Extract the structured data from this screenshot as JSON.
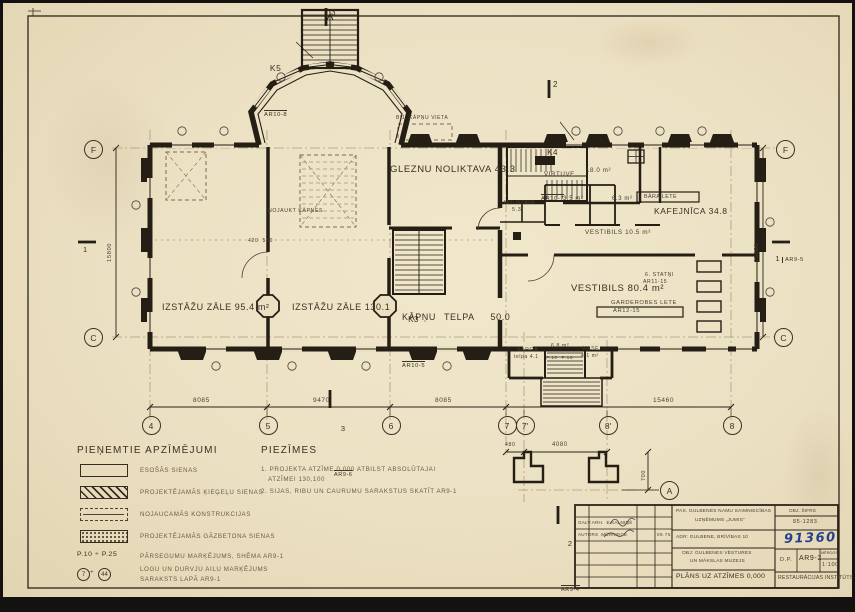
{
  "plan": {
    "stairs": {
      "k5": "K5",
      "k5_ref": "AR10-8",
      "k4": "K4",
      "k4_ref": "AR10-7",
      "k3": "K3",
      "k3_ref": "AR10-5"
    },
    "rooms": {
      "gleznu": "GLEZNU NOLIKTAVA 43.3",
      "izstazu1": "IZSTĀŽU ZĀLE 95.4 m²",
      "izstazu2": "IZSTĀŽU ZĀLE 130.1",
      "kapnu": "KĀPŅU TELPA  50.0",
      "virtuve": "VIRTUVE",
      "virtuve_area": "18.0 m²",
      "noliktava": "NOLIKTAVA",
      "noliktava_area": "5.3",
      "kafejnica": "KAFEJNĪCA 34.8",
      "vestibils1": "VESTIBILS 10.5 m²",
      "vestibils2": "VESTIBILS 80.4 m²",
      "bara_lete": "BĀRA LETE",
      "garderobe": "GARDEROBES LETE",
      "garderobe_ref": "AR12-15",
      "statni": "6. STATŅI",
      "statni_ref": "AR11-15",
      "sarga": "SARGA",
      "sarga_telpa": "telpa 4.1",
      "sarga_area": "6.8 m²",
      "kase": "KASE",
      "kase_area": "4.1 m²",
      "r35": "3.5 m²",
      "r63": "6.3 m²",
      "p10": "P.10  P.10"
    },
    "annot": {
      "bij": "BIJ. KĀPŅU VIETA",
      "nojaukt": "NOJAUKT KĀPNES",
      "d420": "420  550"
    },
    "grid": {
      "bottom": [
        "4",
        "5",
        "6",
        "7",
        "7'",
        "8'",
        "8"
      ],
      "f": "F",
      "c": "C",
      "a": "A"
    },
    "dims": {
      "d1": "8085",
      "d2": "9470",
      "d3": "8085",
      "d4": "15460",
      "d5": "480",
      "d6": "4080",
      "d7": "700",
      "v": "15800"
    },
    "sec": {
      "n1": "1",
      "n2": "2",
      "n3": "3",
      "r1": "AR9-5",
      "r2": "AR9-4",
      "r3": "AR9-6"
    }
  },
  "legend": {
    "title": "PIEŅEMTIE APZĪMĒJUMI",
    "items": [
      {
        "label": "ESOŠĀS SIENAS"
      },
      {
        "label": "PROJEKTĒJAMĀS ĶIEĢEĻU SIENAS"
      },
      {
        "label": "NOJAUCAMĀS KONSTRUKCIJAS"
      },
      {
        "label": "PROJEKTĒJAMĀS GĀZBETONA SIENAS"
      },
      {
        "key": "P.10 ÷ P.25",
        "label": "PĀRSEGUMU MARĶĒJUMS, SHĒMA AR9-1"
      },
      {
        "k1": "7",
        "sep": "÷",
        "k2": "44",
        "label": "LOGU UN DURVJU AILU MARĶĒJUMS",
        "label2": "SARAKSTS LAPĀ AR9-1"
      }
    ]
  },
  "notes": {
    "title": "PIEZĪMES",
    "line1": "1. PROJEKTA ATZĪME 0,000 ATBILST ABSOLŪTAJAI",
    "line2": "ATZĪMEI 130,100",
    "line3": "2. SIJAS, RIBU UN CAURUMU SARAKSTUS SKATĪT AR9-1"
  },
  "titleblock": {
    "galv": "GALV.ARH.  E.KALNIŅŠ",
    "autors": "AUTORS  MŪRNIECE",
    "date": "09.75",
    "pas1": "PAS. GULBENES NAMU SAIMNIECĪBAS",
    "pas2": "UZŅĒMUMS „JUMIS”",
    "adr": "ADR: GULBENE, BRĪVĪBAS 10",
    "obj1": "OBJ: GULBENES VĒSTURES",
    "obj2": "UN MĀKSLAS MUZEJS",
    "sifrs_label": "OBJ. ŠIFRS",
    "sifrs": "85-1283",
    "handwritten": "91360",
    "dp": "D.P.",
    "sheet": "AR9-2",
    "scale_label": "MĒROGS",
    "scale": "1:100",
    "title": "PLĀNS UZ ATZĪMES 0,000",
    "org": "RESTAURĀCIJAS INSTITŪTS"
  }
}
